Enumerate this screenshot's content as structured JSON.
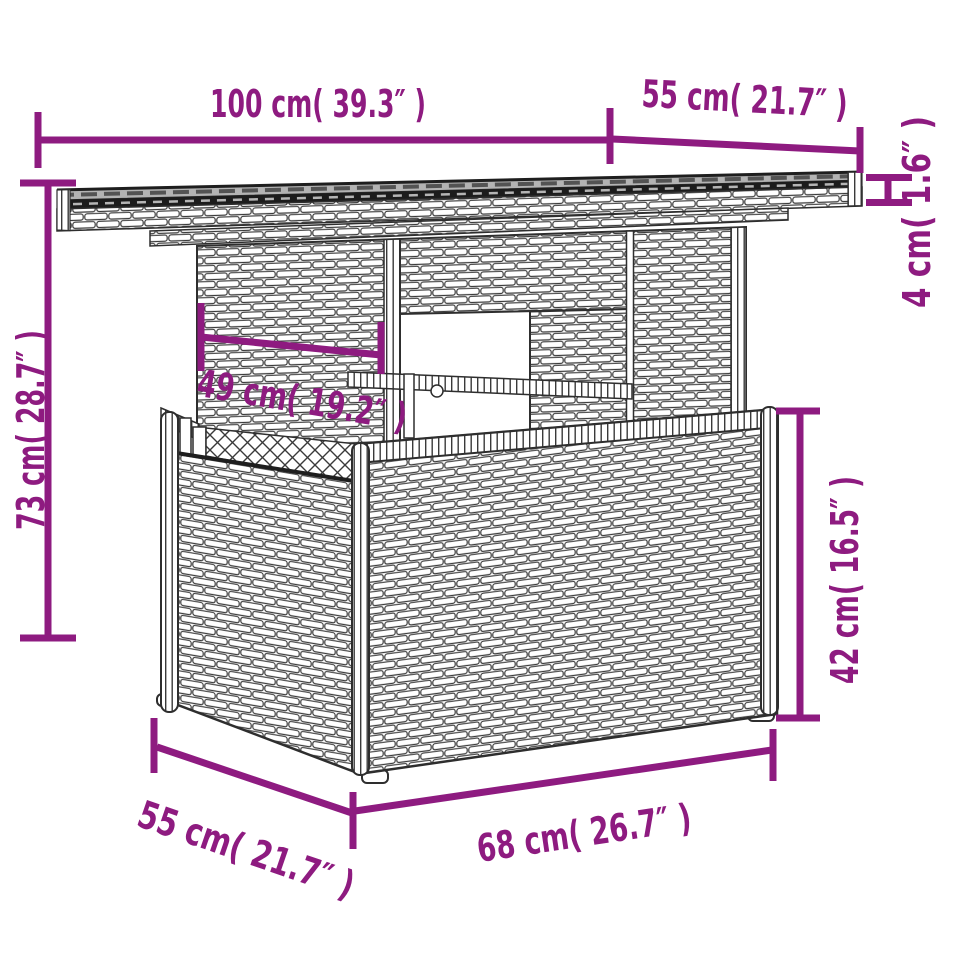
{
  "figure": {
    "subject": "poly rattan garden table with glass top",
    "style": "technical line drawing with dimension annotations"
  },
  "colors": {
    "dimension_accent": "#8E1B80",
    "line_art": "#2E2E2E",
    "glass_top_gray": "#B3B3B3",
    "glass_edge_dark": "#1C1C1C",
    "background": "#FFFFFF"
  },
  "dimensions": {
    "tabletop_width": "100 cm( 39.3″ )",
    "tabletop_depth": "55 cm( 21.7″ )",
    "tabletop_thickness": "4 cm( 1.6″ )",
    "overall_height": "73 cm( 28.7″ )",
    "pedestal_width": "49 cm( 19.2″ )",
    "base_height": "42 cm( 16.5″ )",
    "base_depth": "55 cm( 21.7″ )",
    "base_width": "68 cm( 26.7″ )"
  }
}
